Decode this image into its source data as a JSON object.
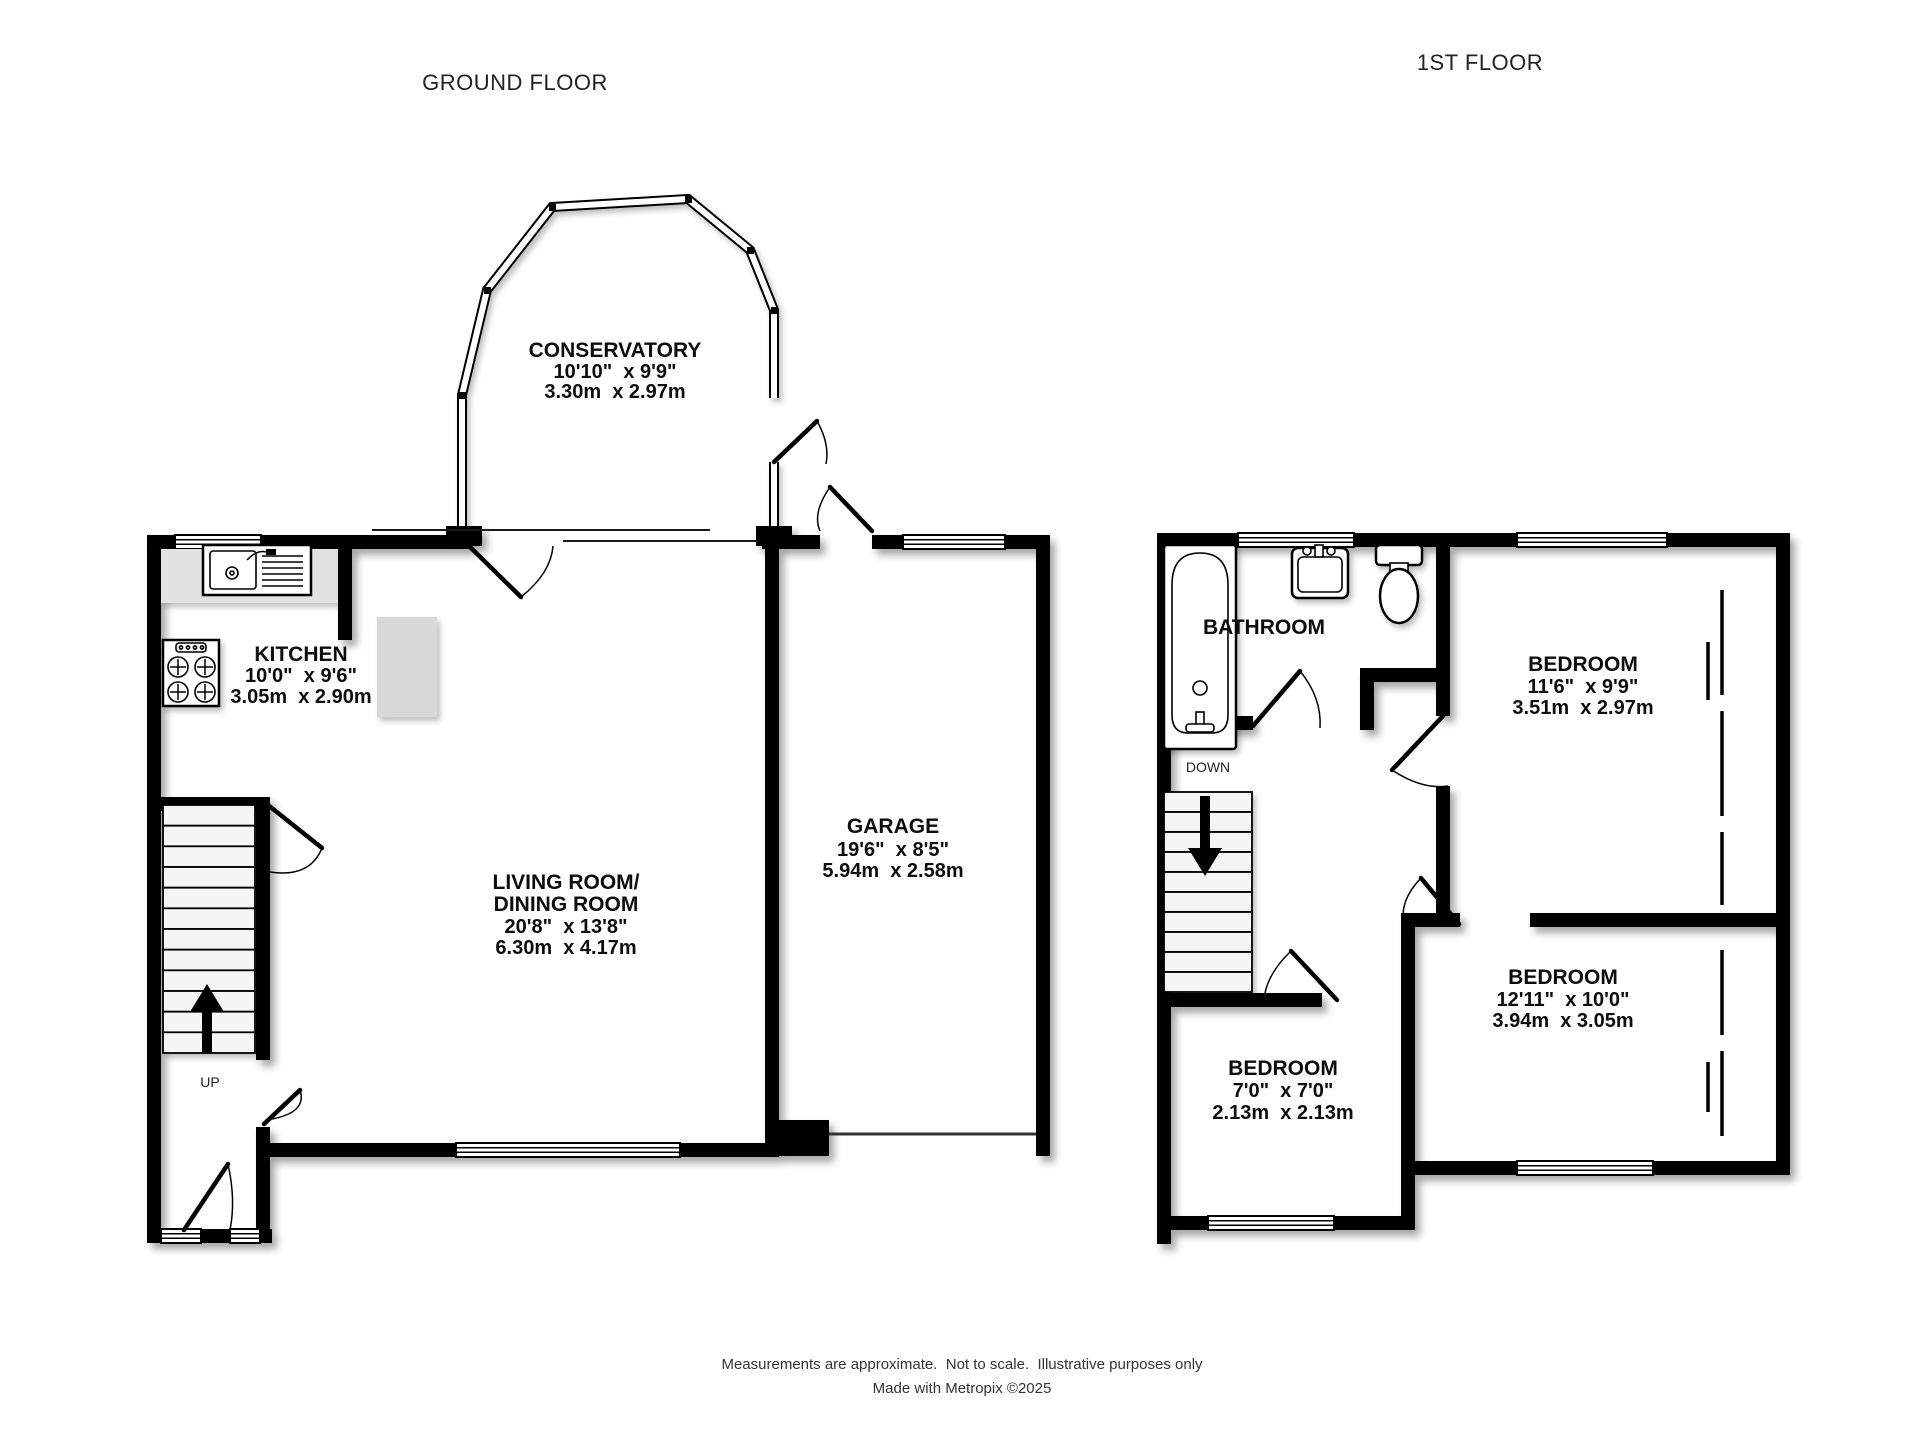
{
  "page": {
    "title_ground": "GROUND FLOOR",
    "title_first": "1ST FLOOR"
  },
  "ground": {
    "conservatory": {
      "name": "CONSERVATORY",
      "imperial": "10'10\"  x 9'9\"",
      "metric": "3.30m  x 2.97m"
    },
    "kitchen": {
      "name": "KITCHEN",
      "imperial": "10'0\"  x 9'6\"",
      "metric": "3.05m  x 2.90m"
    },
    "living": {
      "name1": "LIVING ROOM/",
      "name2": "DINING ROOM",
      "imperial": "20'8\"  x 13'8\"",
      "metric": "6.30m  x 4.17m"
    },
    "garage": {
      "name": "GARAGE",
      "imperial": "19'6\"  x 8'5\"",
      "metric": "5.94m  x 2.58m"
    },
    "stairs": {
      "label": "UP"
    }
  },
  "first": {
    "bathroom": {
      "name": "BATHROOM"
    },
    "bedroom1": {
      "name": "BEDROOM",
      "imperial": "11'6\"  x 9'9\"",
      "metric": "3.51m  x 2.97m"
    },
    "bedroom2": {
      "name": "BEDROOM",
      "imperial": "12'11\"  x 10'0\"",
      "metric": "3.94m  x 3.05m"
    },
    "bedroom3": {
      "name": "BEDROOM",
      "imperial": "7'0\"  x 7'0\"",
      "metric": "2.13m  x 2.13m"
    },
    "stairs": {
      "label": "DOWN"
    }
  },
  "footer": {
    "line1": "Measurements are approximate.  Not to scale.  Illustrative purposes only",
    "line2": "Made with Metropix ©2025"
  },
  "colors": {
    "wall": "#000000",
    "room_text": "#0d0d0d",
    "counter": "#e2e2e2",
    "appliance": "#d8d8d8"
  }
}
